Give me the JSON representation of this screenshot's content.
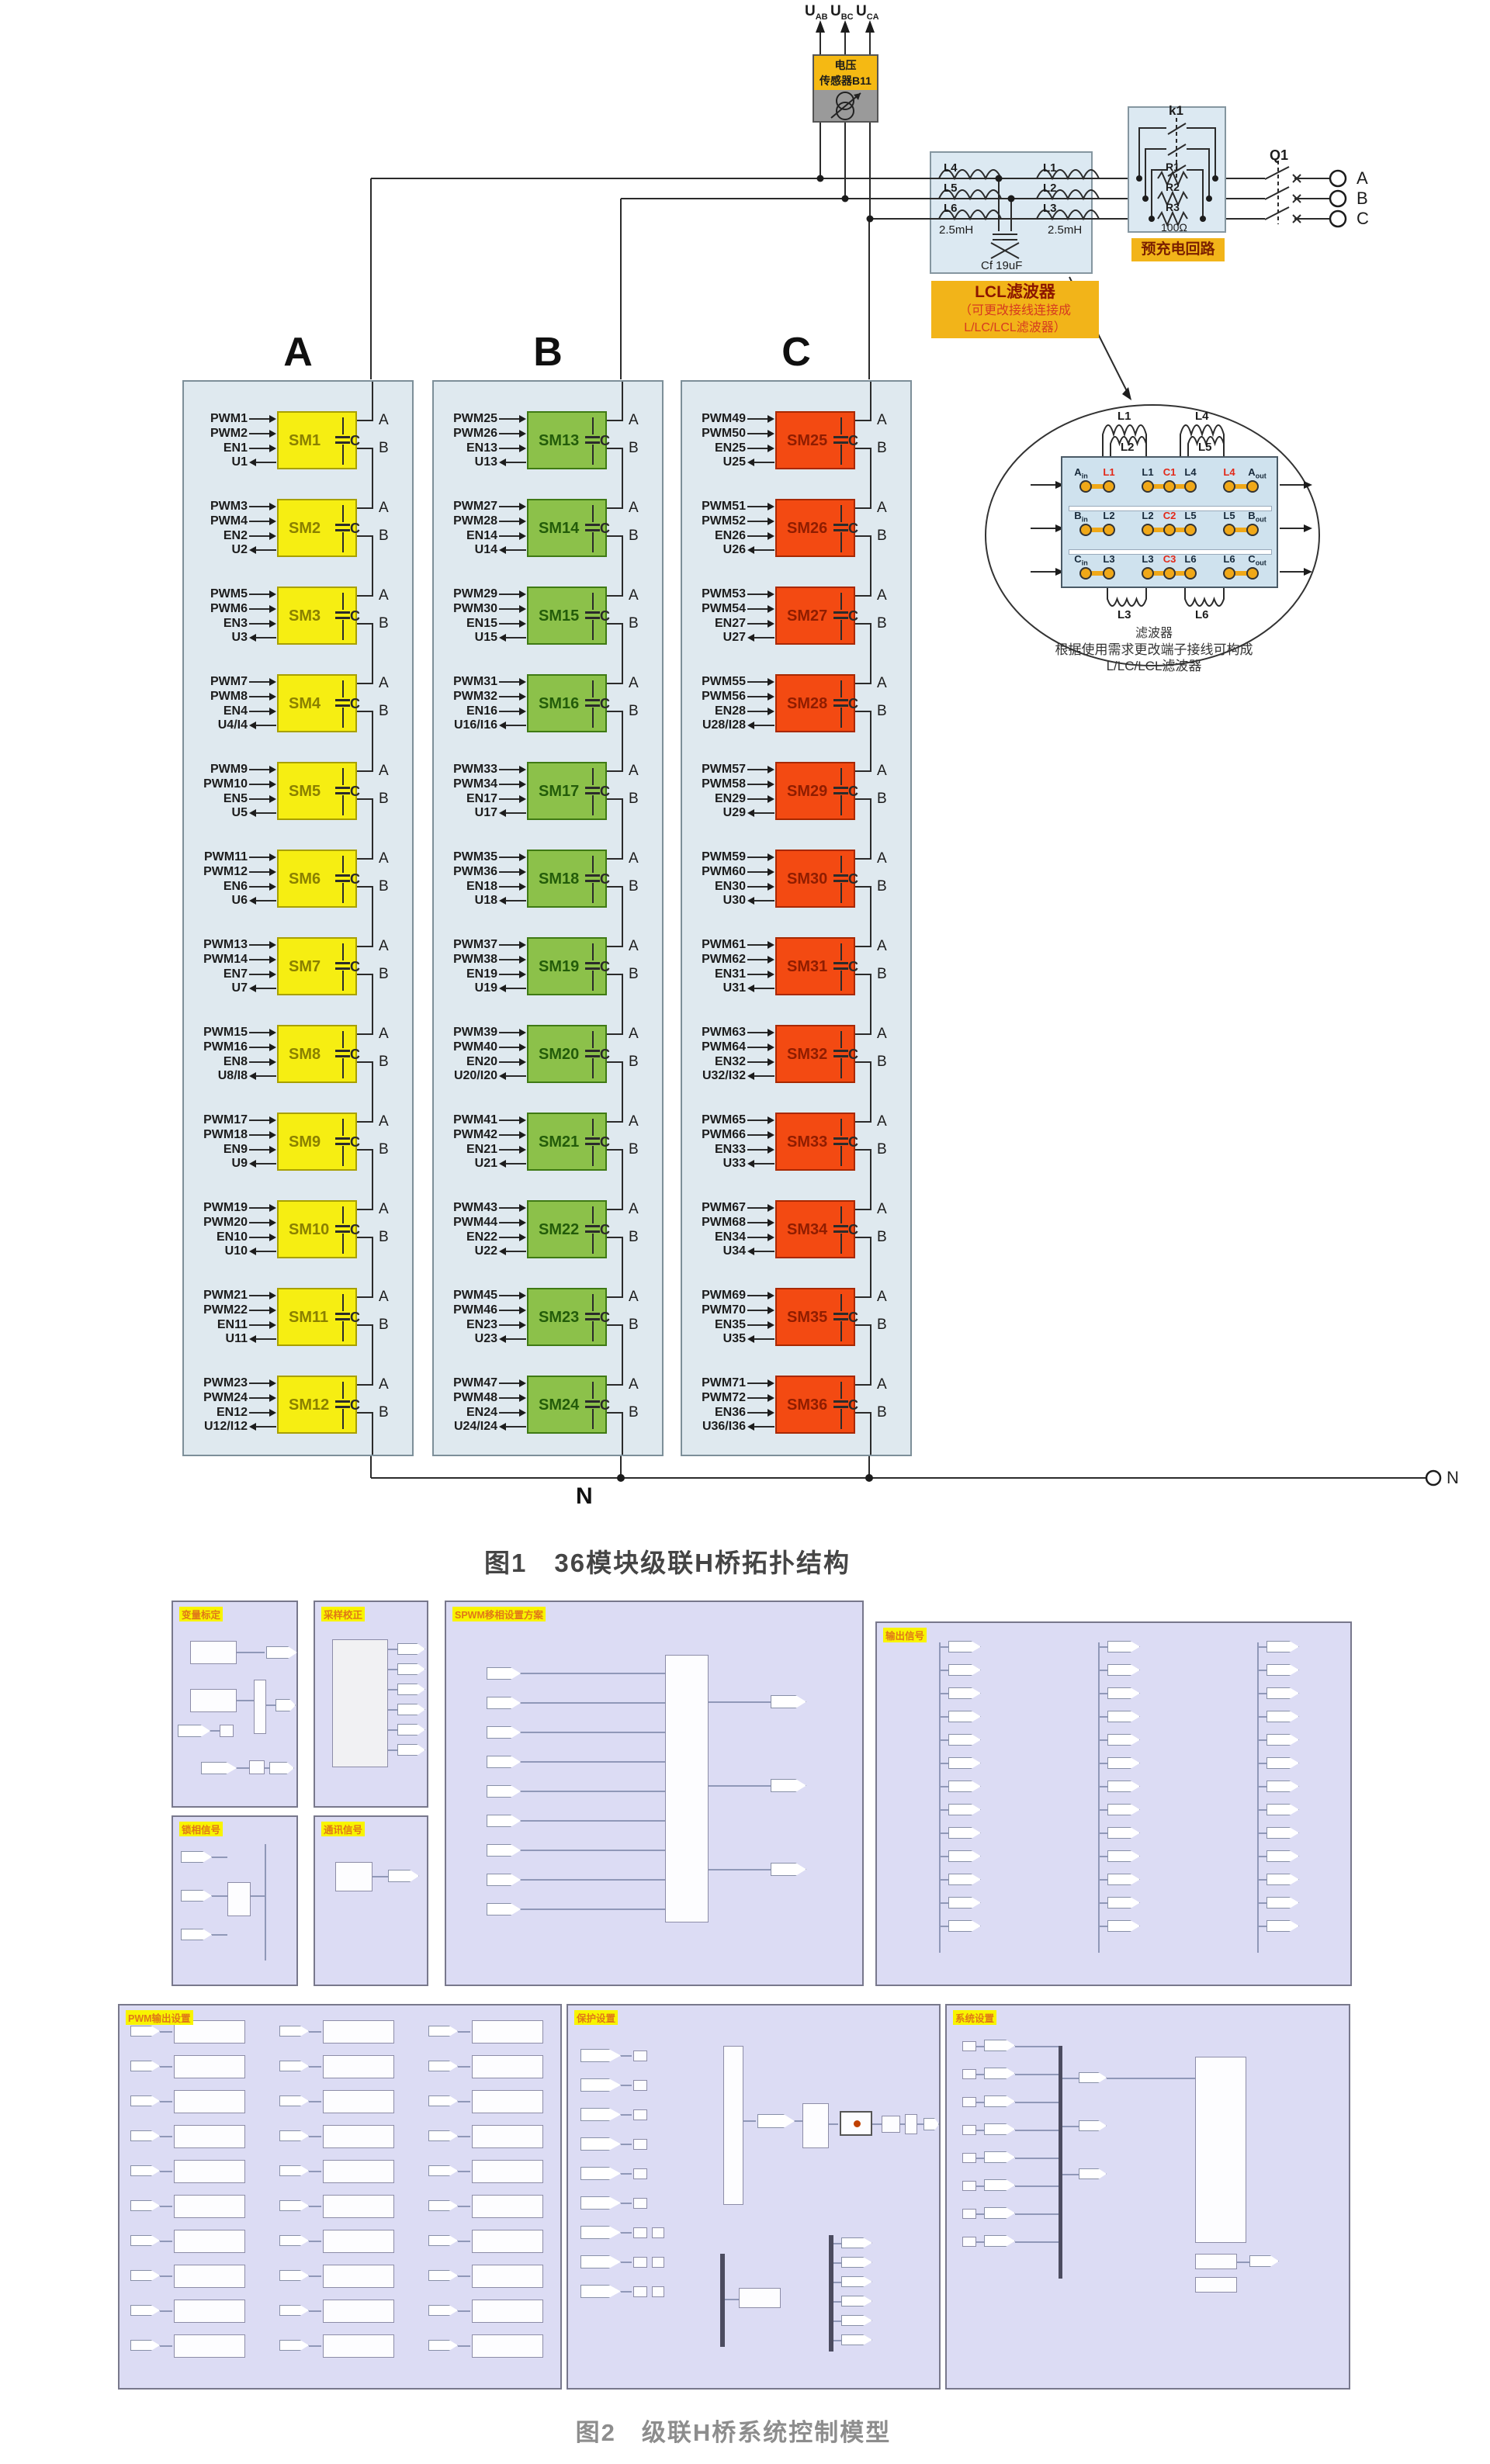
{
  "figure1": {
    "caption": "图1　36模块级联H桥拓扑结构",
    "sensor": {
      "line1": "电压",
      "line2": "传感器B11",
      "outputs": [
        {
          "base": "U",
          "sub": "AB"
        },
        {
          "base": "U",
          "sub": "BC"
        },
        {
          "base": "U",
          "sub": "CA"
        }
      ]
    },
    "precharge": {
      "tag": "预充电回路",
      "contactor": "k1",
      "resistors": [
        "R1",
        "R2",
        "R3"
      ],
      "resistance": "100Ω"
    },
    "breaker": "Q1",
    "grid_terminals": [
      "A",
      "B",
      "C"
    ],
    "neutral": {
      "bus_label": "N",
      "terminal_label": "N"
    },
    "lcl": {
      "tag_title": "LCL滤波器",
      "tag_line1": "（可更改接线连接成",
      "tag_line2": "L/LC/LCL滤波器）",
      "left_coils": [
        "L4",
        "L5",
        "L6"
      ],
      "right_coils": [
        "L1",
        "L2",
        "L3"
      ],
      "left_value": "2.5mH",
      "right_value": "2.5mH",
      "capacitor": "Cf 19uF"
    },
    "filter_detail": {
      "coils": {
        "l1": "L1",
        "l2": "L2",
        "l3": "L3",
        "l4": "L4",
        "l5": "L5",
        "l6": "L6"
      },
      "rows": [
        {
          "in": {
            "base": "A",
            "sub": "in"
          },
          "terminals": [
            {
              "t": "L1",
              "red": true
            },
            {
              "t": "L1",
              "red": false
            },
            {
              "t": "C1",
              "red": true
            },
            {
              "t": "L4",
              "red": false
            },
            {
              "t": "L4",
              "red": true
            }
          ],
          "out": {
            "base": "A",
            "sub": "out"
          }
        },
        {
          "in": {
            "base": "B",
            "sub": "in"
          },
          "terminals": [
            {
              "t": "L2",
              "red": false
            },
            {
              "t": "L2",
              "red": false
            },
            {
              "t": "C2",
              "red": true
            },
            {
              "t": "L5",
              "red": false
            },
            {
              "t": "L5",
              "red": false
            }
          ],
          "out": {
            "base": "B",
            "sub": "out"
          }
        },
        {
          "in": {
            "base": "C",
            "sub": "in"
          },
          "terminals": [
            {
              "t": "L3",
              "red": false
            },
            {
              "t": "L3",
              "red": false
            },
            {
              "t": "C3",
              "red": true
            },
            {
              "t": "L6",
              "red": false
            },
            {
              "t": "L6",
              "red": false
            }
          ],
          "out": {
            "base": "C",
            "sub": "out"
          }
        }
      ],
      "caption_line1": "滤波器",
      "caption_line2": "根据使用需求更改端子接线可构成",
      "caption_line3": "L/LC/LCL滤波器"
    },
    "module_terminal_a": "A",
    "module_terminal_b": "B",
    "module_cap_label": "C",
    "phases": [
      {
        "header": "A",
        "colors": {
          "bg": "#f6ee12",
          "border": "#a8a000",
          "text": "#8a8000"
        },
        "modules": [
          {
            "sm": "SM1",
            "in1": "PWM1",
            "in2": "PWM2",
            "en": "EN1",
            "out": "U1"
          },
          {
            "sm": "SM2",
            "in1": "PWM3",
            "in2": "PWM4",
            "en": "EN2",
            "out": "U2"
          },
          {
            "sm": "SM3",
            "in1": "PWM5",
            "in2": "PWM6",
            "en": "EN3",
            "out": "U3"
          },
          {
            "sm": "SM4",
            "in1": "PWM7",
            "in2": "PWM8",
            "en": "EN4",
            "out": "U4/I4"
          },
          {
            "sm": "SM5",
            "in1": "PWM9",
            "in2": "PWM10",
            "en": "EN5",
            "out": "U5"
          },
          {
            "sm": "SM6",
            "in1": "PWM11",
            "in2": "PWM12",
            "en": "EN6",
            "out": "U6"
          },
          {
            "sm": "SM7",
            "in1": "PWM13",
            "in2": "PWM14",
            "en": "EN7",
            "out": "U7"
          },
          {
            "sm": "SM8",
            "in1": "PWM15",
            "in2": "PWM16",
            "en": "EN8",
            "out": "U8/I8"
          },
          {
            "sm": "SM9",
            "in1": "PWM17",
            "in2": "PWM18",
            "en": "EN9",
            "out": "U9"
          },
          {
            "sm": "SM10",
            "in1": "PWM19",
            "in2": "PWM20",
            "en": "EN10",
            "out": "U10"
          },
          {
            "sm": "SM11",
            "in1": "PWM21",
            "in2": "PWM22",
            "en": "EN11",
            "out": "U11"
          },
          {
            "sm": "SM12",
            "in1": "PWM23",
            "in2": "PWM24",
            "en": "EN12",
            "out": "U12/I12"
          }
        ]
      },
      {
        "header": "B",
        "colors": {
          "bg": "#8cc14a",
          "border": "#3f7a14",
          "text": "#235c0a"
        },
        "modules": [
          {
            "sm": "SM13",
            "in1": "PWM25",
            "in2": "PWM26",
            "en": "EN13",
            "out": "U13"
          },
          {
            "sm": "SM14",
            "in1": "PWM27",
            "in2": "PWM28",
            "en": "EN14",
            "out": "U14"
          },
          {
            "sm": "SM15",
            "in1": "PWM29",
            "in2": "PWM30",
            "en": "EN15",
            "out": "U15"
          },
          {
            "sm": "SM16",
            "in1": "PWM31",
            "in2": "PWM32",
            "en": "EN16",
            "out": "U16/I16"
          },
          {
            "sm": "SM17",
            "in1": "PWM33",
            "in2": "PWM34",
            "en": "EN17",
            "out": "U17"
          },
          {
            "sm": "SM18",
            "in1": "PWM35",
            "in2": "PWM36",
            "en": "EN18",
            "out": "U18"
          },
          {
            "sm": "SM19",
            "in1": "PWM37",
            "in2": "PWM38",
            "en": "EN19",
            "out": "U19"
          },
          {
            "sm": "SM20",
            "in1": "PWM39",
            "in2": "PWM40",
            "en": "EN20",
            "out": "U20/I20"
          },
          {
            "sm": "SM21",
            "in1": "PWM41",
            "in2": "PWM42",
            "en": "EN21",
            "out": "U21"
          },
          {
            "sm": "SM22",
            "in1": "PWM43",
            "in2": "PWM44",
            "en": "EN22",
            "out": "U22"
          },
          {
            "sm": "SM23",
            "in1": "PWM45",
            "in2": "PWM46",
            "en": "EN23",
            "out": "U23"
          },
          {
            "sm": "SM24",
            "in1": "PWM47",
            "in2": "PWM48",
            "en": "EN24",
            "out": "U24/I24"
          }
        ]
      },
      {
        "header": "C",
        "colors": {
          "bg": "#f34a12",
          "border": "#a82800",
          "text": "#8f1d00"
        },
        "modules": [
          {
            "sm": "SM25",
            "in1": "PWM49",
            "in2": "PWM50",
            "en": "EN25",
            "out": "U25"
          },
          {
            "sm": "SM26",
            "in1": "PWM51",
            "in2": "PWM52",
            "en": "EN26",
            "out": "U26"
          },
          {
            "sm": "SM27",
            "in1": "PWM53",
            "in2": "PWM54",
            "en": "EN27",
            "out": "U27"
          },
          {
            "sm": "SM28",
            "in1": "PWM55",
            "in2": "PWM56",
            "en": "EN28",
            "out": "U28/I28"
          },
          {
            "sm": "SM29",
            "in1": "PWM57",
            "in2": "PWM58",
            "en": "EN29",
            "out": "U29"
          },
          {
            "sm": "SM30",
            "in1": "PWM59",
            "in2": "PWM60",
            "en": "EN30",
            "out": "U30"
          },
          {
            "sm": "SM31",
            "in1": "PWM61",
            "in2": "PWM62",
            "en": "EN31",
            "out": "U31"
          },
          {
            "sm": "SM32",
            "in1": "PWM63",
            "in2": "PWM64",
            "en": "EN32",
            "out": "U32/I32"
          },
          {
            "sm": "SM33",
            "in1": "PWM65",
            "in2": "PWM66",
            "en": "EN33",
            "out": "U33"
          },
          {
            "sm": "SM34",
            "in1": "PWM67",
            "in2": "PWM68",
            "en": "EN34",
            "out": "U34"
          },
          {
            "sm": "SM35",
            "in1": "PWM69",
            "in2": "PWM70",
            "en": "EN35",
            "out": "U35"
          },
          {
            "sm": "SM36",
            "in1": "PWM71",
            "in2": "PWM72",
            "en": "EN36",
            "out": "U36/I36"
          }
        ]
      }
    ]
  },
  "figure2": {
    "caption": "图2　级联H桥系统控制模型",
    "panels": [
      {
        "label": "变量标定"
      },
      {
        "label": "采样校正"
      },
      {
        "label": "SPWM移相设置方案"
      },
      {
        "label": "输出信号"
      },
      {
        "label": "锁相信号"
      },
      {
        "label": "通讯信号"
      },
      {
        "label": "PWM输出设置"
      },
      {
        "label": "保护设置"
      },
      {
        "label": "系统设置"
      }
    ],
    "colors": {
      "panel_bg": "#dcdcf4",
      "label_fg": "#e07818",
      "label_bg": "#f8f400"
    }
  }
}
